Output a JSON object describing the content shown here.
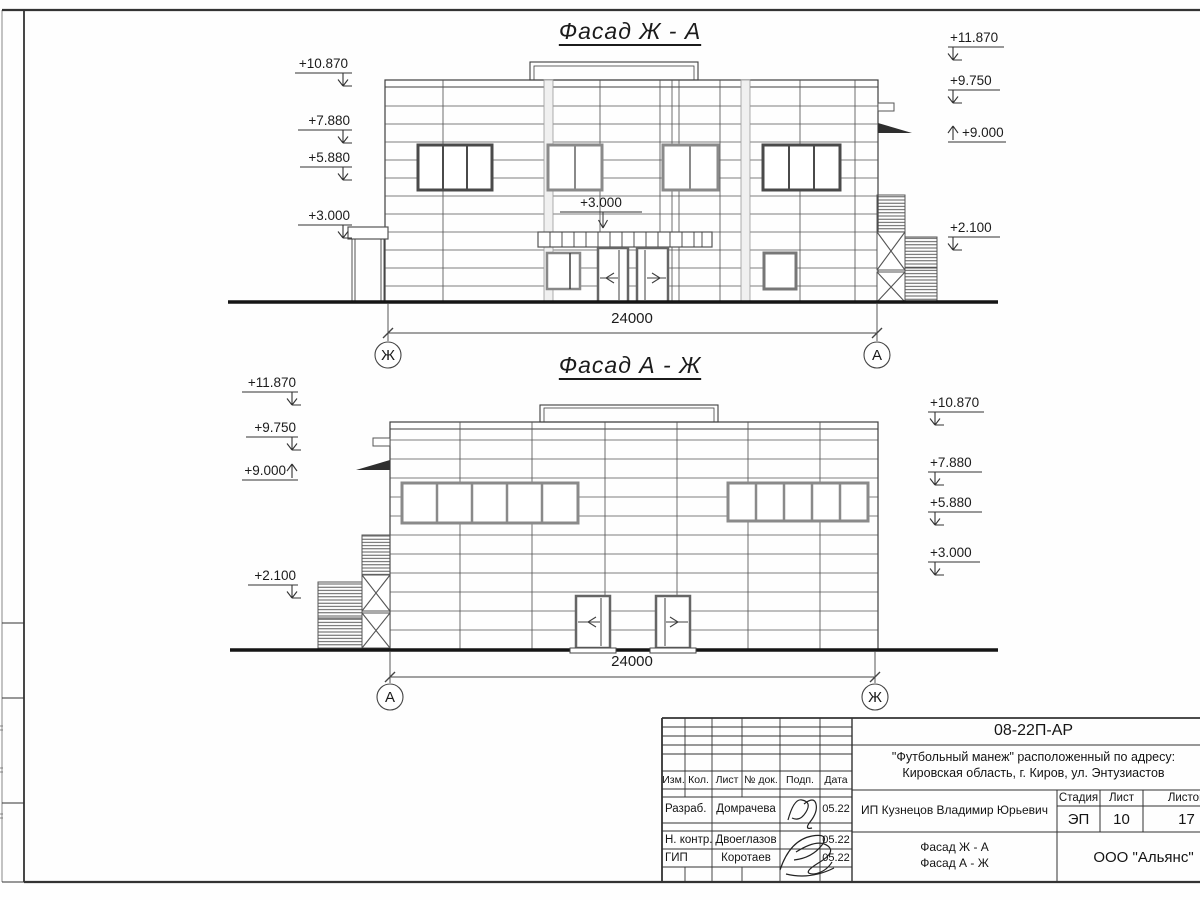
{
  "drawing": {
    "facade1": {
      "title": "Фасад Ж - А",
      "dimension": "24000",
      "axis_left": "Ж",
      "axis_right": "А",
      "marks_left": [
        "+10.870",
        "+7.880",
        "+5.880",
        "+3.000"
      ],
      "marks_right": [
        "+11.870",
        "+9.750",
        "+9.000",
        "+2.100"
      ],
      "mark_internal": "+3.000"
    },
    "facade2": {
      "title": "Фасад А - Ж",
      "dimension": "24000",
      "axis_left": "А",
      "axis_right": "Ж",
      "marks_left": [
        "+11.870",
        "+9.750",
        "+9.000",
        "+2.100"
      ],
      "marks_right": [
        "+10.870",
        "+7.880",
        "+5.880",
        "+3.000"
      ]
    }
  },
  "titleblock": {
    "doc_code": "08-22П-АР",
    "project_line1": "\"Футбольный манеж\" расположенный по адресу:",
    "project_line2": "Кировская область, г. Киров, ул. Энтузиастов",
    "col_izm": "Изм.",
    "col_kol": "Кол.",
    "col_list": "Лист",
    "col_doc": "№ док.",
    "col_podp": "Подп.",
    "col_data": "Дата",
    "row_razrab_role": "Разраб.",
    "row_razrab_name": "Домрачева",
    "row_razrab_date": "05.22",
    "row_nkontr_role": "Н. контр.",
    "row_nkontr_name": "Двоеглазов",
    "row_nkontr_date": "05.22",
    "row_gip_role": "ГИП",
    "row_gip_name": "Коротаев",
    "row_gip_date": "05.22",
    "client": "ИП Кузнецов Владимир Юрьевич",
    "stage_label": "Стадия",
    "list_label": "Лист",
    "listov_label": "Листов",
    "stage": "ЭП",
    "sheet_number": "10",
    "sheets_total": "17",
    "sheet_title_line1": "Фасад Ж - А",
    "sheet_title_line2": "Фасад А - Ж",
    "organization": "ООО \"Альянс\""
  }
}
